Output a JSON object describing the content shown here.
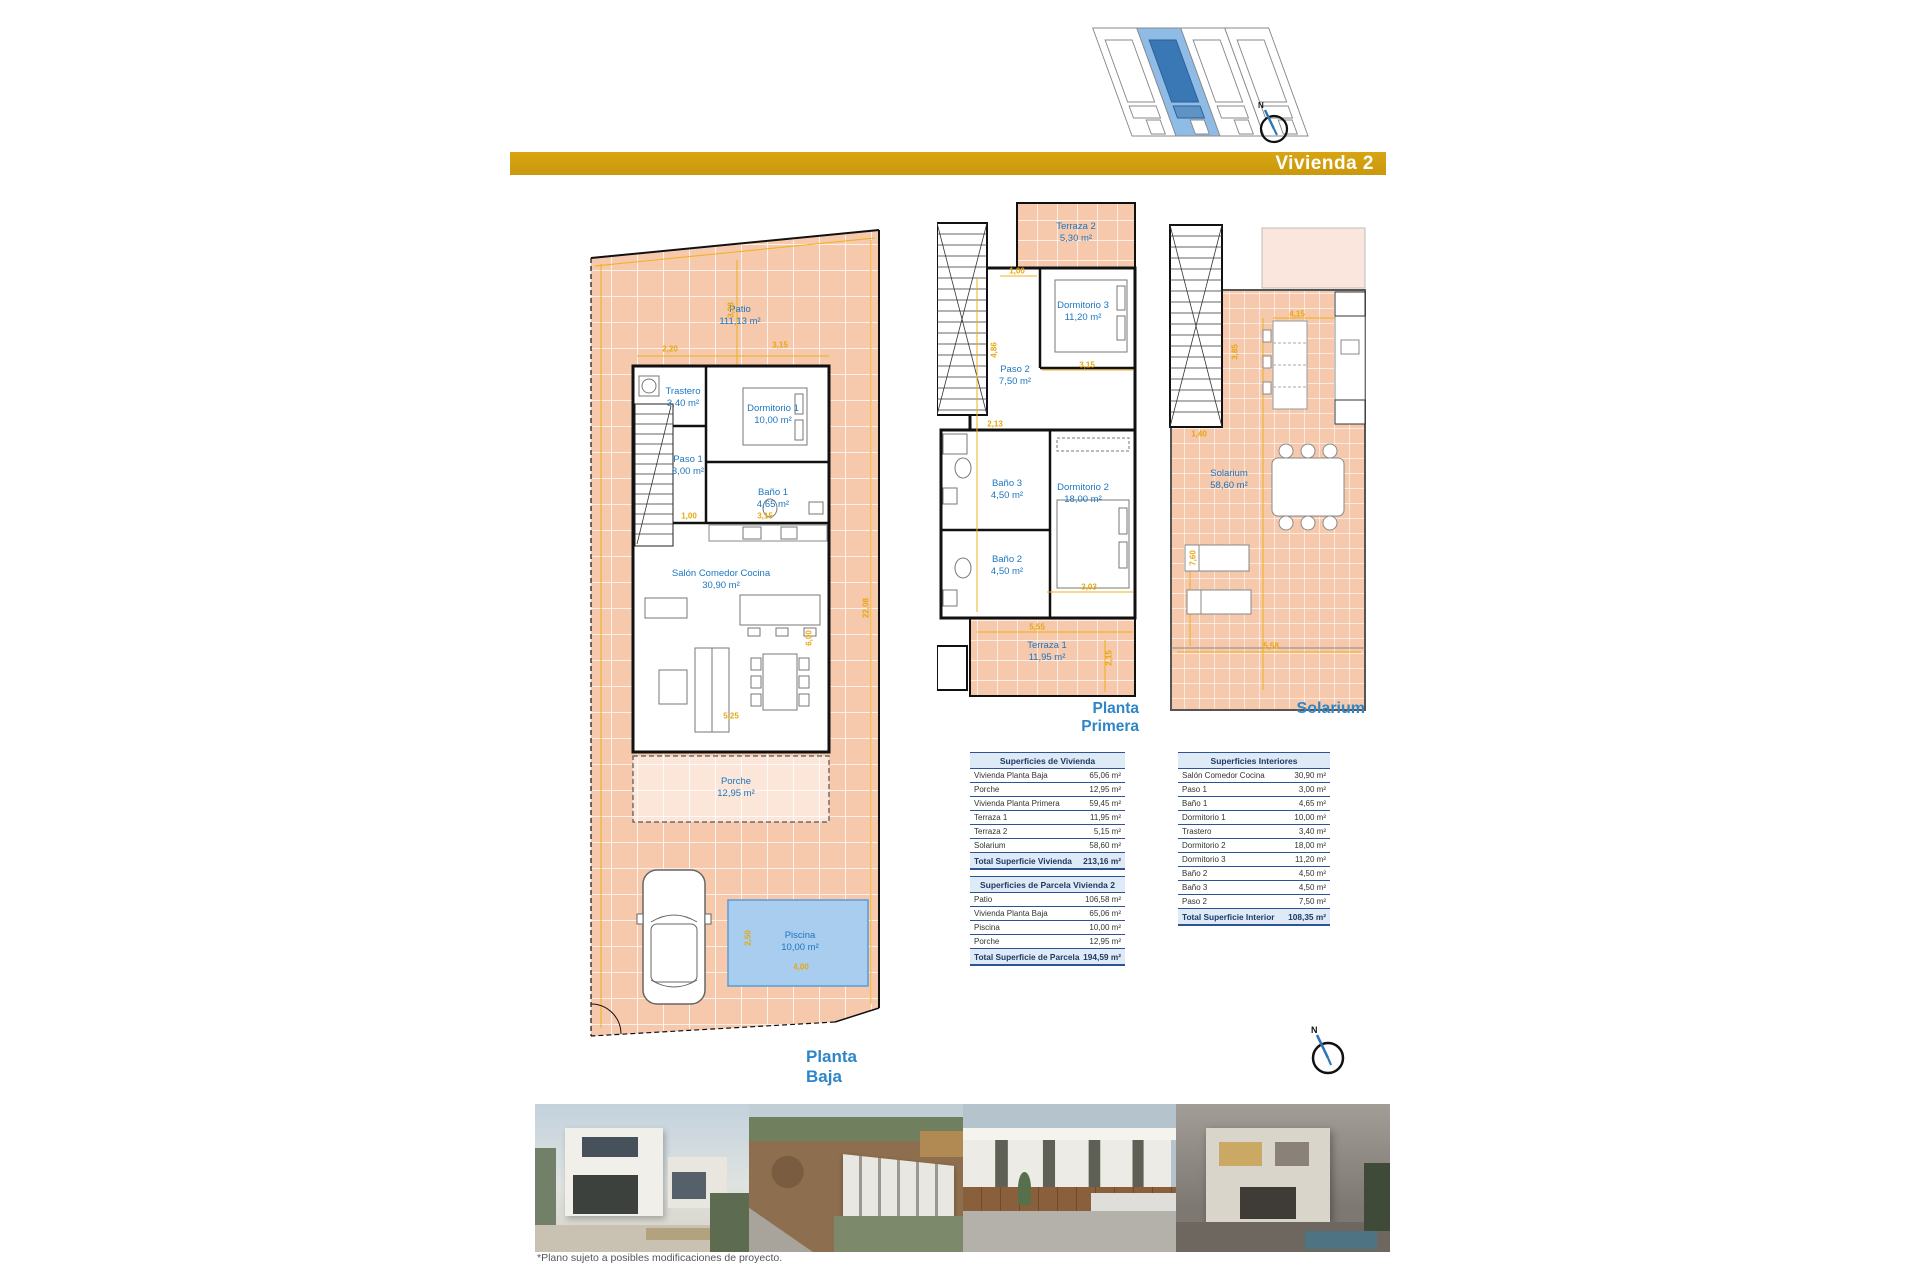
{
  "header": {
    "title": "Vivienda 2"
  },
  "compass": {
    "north": "N"
  },
  "plans": {
    "baja": {
      "title": "Planta Baja",
      "rooms": [
        {
          "name": "Patio",
          "area": "111,13 m²"
        },
        {
          "name": "Trastero",
          "area": "3,40 m²"
        },
        {
          "name": "Dormitorio 1",
          "area": "10,00 m²"
        },
        {
          "name": "Paso 1",
          "area": "3,00 m²"
        },
        {
          "name": "Baño 1",
          "area": "4,65 m²"
        },
        {
          "name": "Salón Comedor Cocina",
          "area": "30,90 m²"
        },
        {
          "name": "Porche",
          "area": "12,95 m²"
        },
        {
          "name": "Piscina",
          "area": "10,00 m²"
        }
      ],
      "dims": [
        "2,20",
        "3,15",
        "1,00",
        "3,15",
        "5,25",
        "6,00",
        "22,08",
        "3,28",
        "4,00",
        "2,50"
      ]
    },
    "primera": {
      "title": "Planta Primera",
      "rooms": [
        {
          "name": "Terraza 2",
          "area": "5,30 m²"
        },
        {
          "name": "Dormitorio 3",
          "area": "11,20 m²"
        },
        {
          "name": "Paso 2",
          "area": "7,50 m²"
        },
        {
          "name": "Baño 3",
          "area": "4,50 m²"
        },
        {
          "name": "Dormitorio 2",
          "area": "18,00 m²"
        },
        {
          "name": "Baño 2",
          "area": "4,50 m²"
        },
        {
          "name": "Terraza 1",
          "area": "11,95 m²"
        }
      ],
      "dims": [
        "1,00",
        "4,86",
        "3,15",
        "2,13",
        "3,03",
        "5,55",
        "2,15"
      ]
    },
    "solarium": {
      "title": "Solarium",
      "rooms": [
        {
          "name": "Solarium",
          "area": "58,60 m²"
        }
      ],
      "dims": [
        "1,40",
        "4,15",
        "3,85",
        "7,60",
        "5,58"
      ]
    }
  },
  "tables": {
    "vivienda": {
      "header": "Superficies de Vivienda",
      "rows": [
        {
          "label": "Vivienda Planta Baja",
          "value": "65,06 m²"
        },
        {
          "label": "Porche",
          "value": "12,95 m²"
        },
        {
          "label": "Vivienda Planta Primera",
          "value": "59,45 m²"
        },
        {
          "label": "Terraza 1",
          "value": "11,95 m²"
        },
        {
          "label": "Terraza 2",
          "value": "5,15 m²"
        },
        {
          "label": "Solarium",
          "value": "58,60 m²"
        }
      ],
      "total": {
        "label": "Total Superficie Vivienda",
        "value": "213,16 m²"
      }
    },
    "parcela": {
      "header": "Superficies de Parcela Vivienda 2",
      "rows": [
        {
          "label": "Patio",
          "value": "106,58 m²"
        },
        {
          "label": "Vivienda Planta Baja",
          "value": "65,06 m²"
        },
        {
          "label": "Piscina",
          "value": "10,00 m²"
        },
        {
          "label": "Porche",
          "value": "12,95 m²"
        }
      ],
      "total": {
        "label": "Total Superficie de Parcela",
        "value": "194,59 m²"
      }
    },
    "interiores": {
      "header": "Superficies Interiores",
      "rows": [
        {
          "label": "Salón Comedor Cocina",
          "value": "30,90 m²"
        },
        {
          "label": "Paso 1",
          "value": "3,00 m²"
        },
        {
          "label": "Baño 1",
          "value": "4,65 m²"
        },
        {
          "label": "Dormitorio 1",
          "value": "10,00 m²"
        },
        {
          "label": "Trastero",
          "value": "3,40 m²"
        },
        {
          "label": "Dormitorio 2",
          "value": "18,00 m²"
        },
        {
          "label": "Dormitorio 3",
          "value": "11,20 m²"
        },
        {
          "label": "Baño 2",
          "value": "4,50 m²"
        },
        {
          "label": "Baño 3",
          "value": "4,50 m²"
        },
        {
          "label": "Paso 2",
          "value": "7,50 m²"
        }
      ],
      "total": {
        "label": "Total Superficie Interior",
        "value": "108,35 m²"
      }
    }
  },
  "footnote": "*Plano sujeto a posibles modificaciones de proyecto.",
  "colors": {
    "accent_gold": "#CC990D",
    "plan_blue": "#1D76C0",
    "tile_salmon": "#F6C8AC",
    "highlight_blue": "#8FBCE6"
  }
}
